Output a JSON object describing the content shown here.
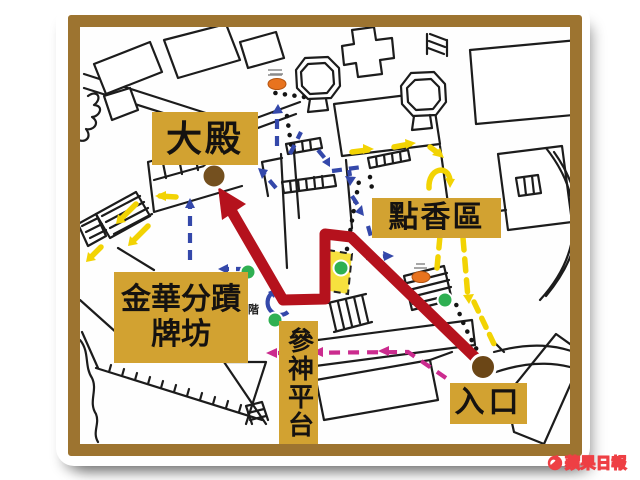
{
  "labels": {
    "main_hall": "大殿",
    "incense_area": "點香區",
    "archway_line1": "金華分蹟",
    "archway_line2": "牌坊",
    "worship_platform": "參神平台",
    "entrance": "入口",
    "stairs_note": "階"
  },
  "watermark": {
    "text": "蘋果日報"
  },
  "colors": {
    "frame_brown": "#9d7430",
    "label_gold": "#d2a231",
    "route_red": "#b5121d",
    "route_blue_dashed": "#3448aa",
    "route_yellow": "#f2d303",
    "route_magenta_dashed": "#cb2b8e",
    "highlight_zone_yellow": "#f7e13e",
    "marker_green": "#2fb052",
    "marker_brown": "#74501f",
    "marker_orange": "#e8731e",
    "watermark_red": "#ee3f44"
  }
}
